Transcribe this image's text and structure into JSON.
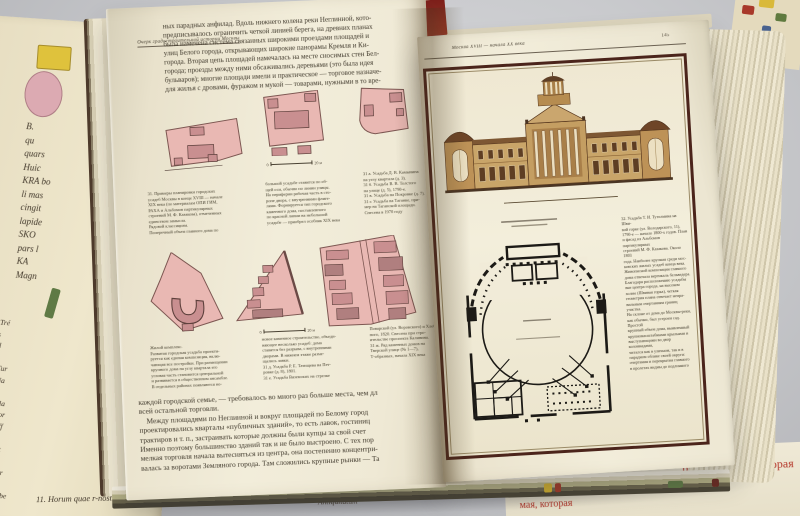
{
  "colors": {
    "background_gray": "#c9cacd",
    "page_cream": "#f0ead7",
    "frame_maroon": "#4b241b",
    "parcel_pink": "#e9b8b3",
    "parcel_building": "#c98f90",
    "sepia_wall": "#c49e62",
    "sepia_roof": "#6e4527",
    "red_caption": "#b5372a"
  },
  "left_page": {
    "running_header": "Очерк градостроительной истории Москвы",
    "top_paragraph": "ных парадных анфилад. Вдоль нижнего колена реки Неглинной, кото-\nпредписывалось ограничить четкой линией берега, на древних планах\nбыла намечена система связанных широкими проездами площадей и\nулиц Белого города, открывающих широкие панорамы Кремля и Ки-\nгорода. Вторая цепь площадей намечалась на месте сносимых стен Бел-\nгорода; проезды между ними обсаживались деревьями (это была идея\nбульваров); многие площади имели и практическое — торговое назначе-\nдля жилья с дровами, фуражом и мукой — товарами, нужными в то вре-",
    "scale_zero": "0",
    "scale_20m": "20 м",
    "captions_row1": {
      "col1": "31. Примеры планировки городских\nусадеб Москвы в конце XVIII — начале\nXIX века (по материалам ОПИ ГИМ,\nРАХА и Альбомов партикулярных\nстроений М. Ф. Казакова), отмеченных\nединством замысла.\nРядовой классицизм.\nПоперечный объем главного дома по",
      "col2": "большой усадьбе ставится по об-\nщей оси, обычно по линии улицы.\nНа периферии рабочая часть в сто-\nроне двора, с внутренними флиге-\nлями. Формируется тип городского\nкаменного дома, поставленного\nпо красной линии на небольшой\nусадьбе — приобрел особняк XIX века",
      "col3": "31 а. Усадьба Д. В. Камынина\nна углу квартала (д. 3).\n31 б. Усадьба В. В. Толстого\nна улице (д. 5), 1790-е.\n31 в. Усадьба на Покровке (д. 7).\n31 г. Усадьба на Таганке, при-\nмер на Таганской площади.\nСнесена в 1970 году"
    },
    "captions_row2": {
      "col1": "Жилой комплекс.\nРазвитая городская усадьба проекти-\nруется как единая композиция, вклю-\nчающая все постройки. При размещении\nкрупного дома на углу квартала его\nугловая часть становится центральной\nи развивается в общественном ансамбле.\nВ отдельных районах появляются но-",
      "col2": "новое каменное строительство, объеди-\nняющее несколько усадеб: дома\nставятся без разрыва, с внутренними\nдворами. В нижнем этаже разме-\nщались лавки.\n31 д. Усадьба Р. Е. Татищева на Пет-\nровке (д. 8), 1801.\n31 е. Усадьба Вяземских на стрелке",
      "col3": "Поварской (ул. Воровского) и Хлеб-\nного, 1820. Снесена при стро-\nительстве проспекта Калинина.\n31 ж. Ряд каменных домов на\nТверской улице (№ 1—7),\nТ-образных, начала XIX века"
    },
    "bottom_paragraph": "каждой городской семье, — требовалось во много раз больше места, чем дл\nвсей остальной торговли.\n    Между площадями по Неглинной и вокруг площадей по Белому город\nпроектировались кварталы «публичных зданий», то есть лавок, гостиниц\nтрактиров и т. п., застраивать которые должны были купцы за свой счет\nИменно поэтому большинство зданий так и не было выстроено. С тех пор\nмелкая торговля начала вытесняться из центра, она постепенно концентри-\nвалась за воротами Земляного города. Там сложились крупные рынки — Та"
  },
  "right_page": {
    "running_header": "Москва XVIII — начала XX века",
    "page_number": "145",
    "caption": "32. Усадьба Т. И. Тутолмина на Шви-\nвой горке (ул. Володарского, 11),\n1790-е — начало 1800-х годов. План\nи фасад из Альбомов партикулярных\nстроений М. Ф. Казакова. Около 1803\nгода. Наиболее крупная среди мос-\nковских жилых усадеб конца века.\nЖивописной композиции главного\nдома отвечала вертикаль бельведера.\nБлагодаря расположению усадьбы\nвне центра города, на высоком\nхолме (Швивая горка), четкая\nгеометрия плана отвечает непра-\nвильным очертаниям границ участка.\nНа склоне от дома до Москвы-реки,\nкак обычно, был устроен сад. Простой\nкрупный объем дома, выявленный\nкрупномасштабными крыльями и\nвыступающими во двор колоннадами,\nчитался как в уличном, так и в\nпарадном облике своей округи:\nочертания и перекрытия главного\nв пролетах видны до подлинного"
  },
  "underlay": {
    "numbers_column": "23\n24\n25\n26\n27\n28",
    "map_fragments_upper": "B.\nqu\nquars\nHuic\nKRA bo\nli mas\ncingit\nlapide\nSKO\npars l\nKA\nMagn",
    "map_legend_lower": "1. Tré\n   ers\n   Pal\n   ins\n2. Tur\n3. Na\n   cult\n4. Pla\n5. Por\n6. Off\n7. Pl\n8. Tat\n   cas q\n9. Mor\n   cas t\n10. Tabe",
    "bottom_script_line": "11. Horum quae r-nost extremitate",
    "bottom_script_right": "Antiquitatum",
    "red_text": "род, та самая, которая",
    "red_text_partial": "мая, которая"
  }
}
